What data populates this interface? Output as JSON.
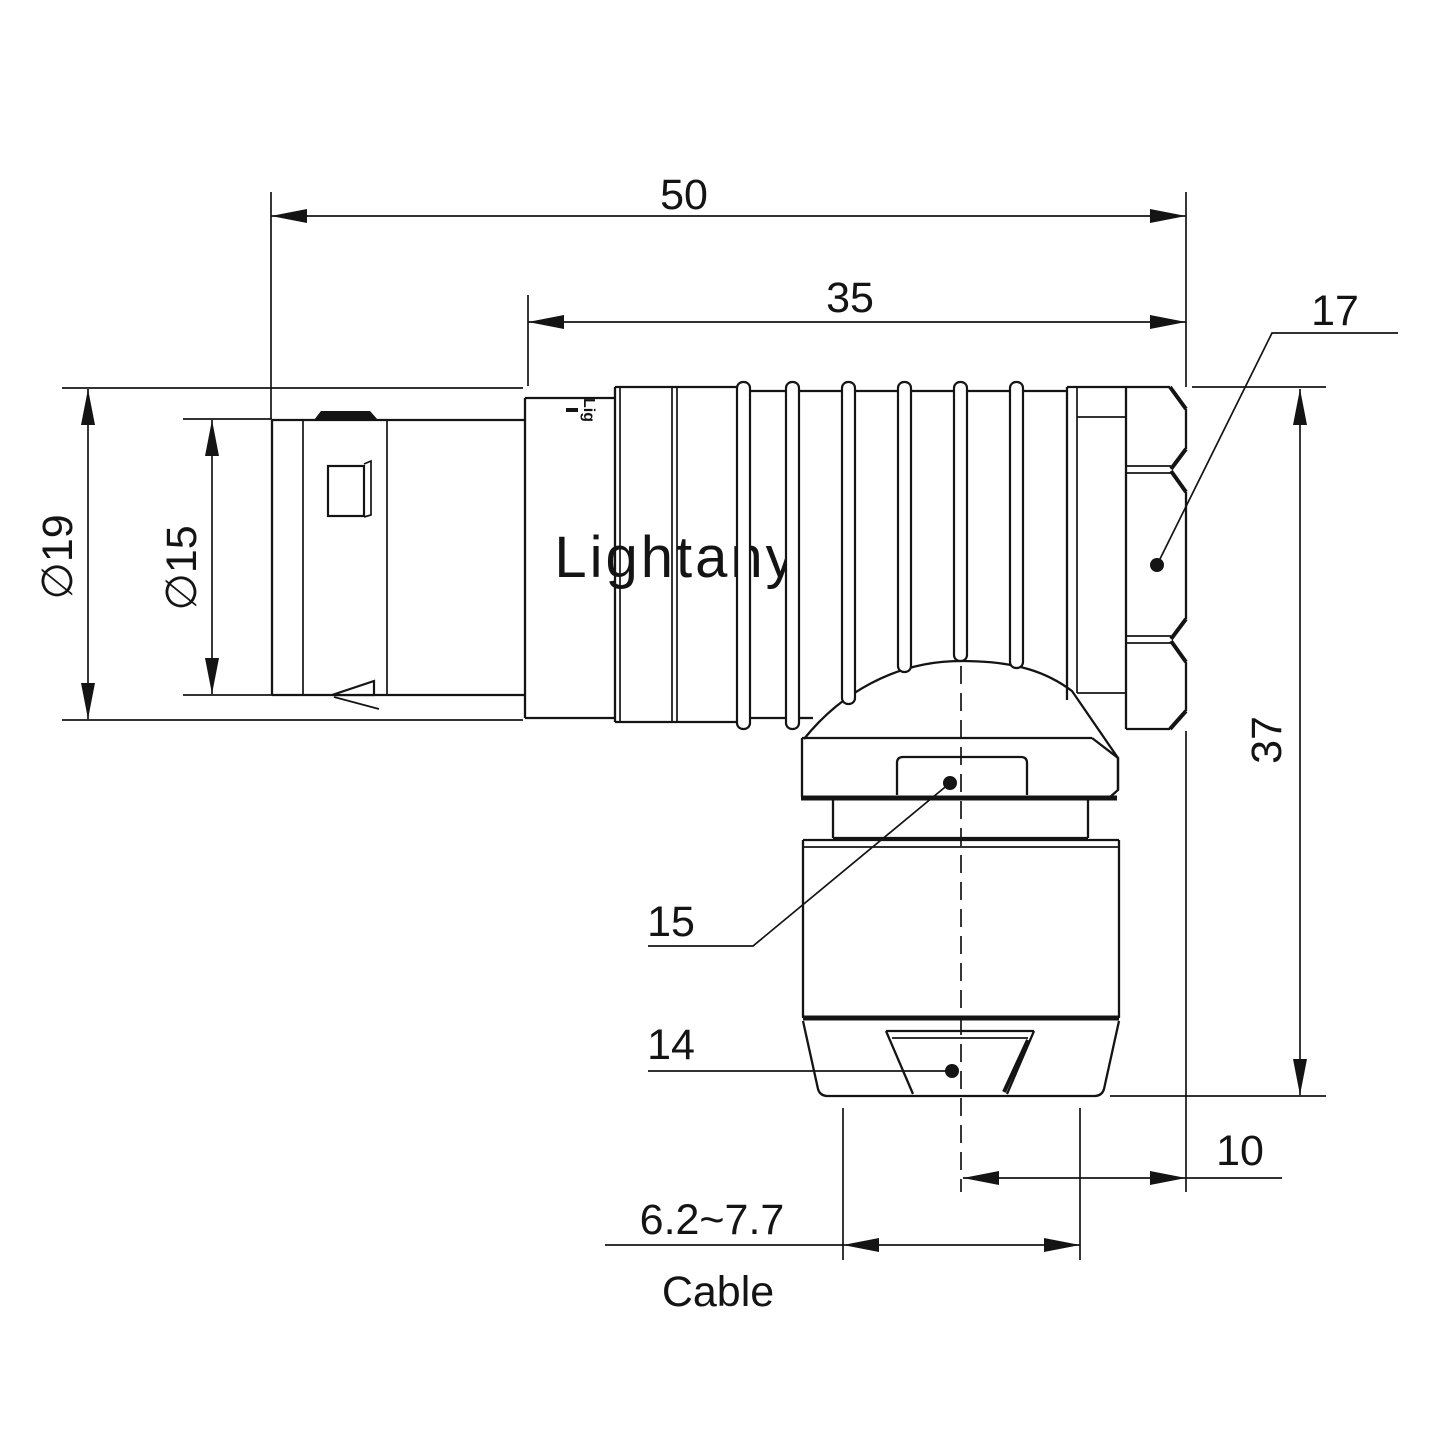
{
  "drawing": {
    "watermark": {
      "text": "Lightany",
      "color": "#f5caca"
    },
    "brand_mark": "Lig",
    "colors": {
      "line": "#141414",
      "background": "#ffffff"
    },
    "dimensions": {
      "length_total": "50",
      "length_coupling": "35",
      "nut_callout": "17",
      "dia_outer": "∅19",
      "dia_inner": "∅15",
      "height_total": "37",
      "clamp_callout": "15",
      "gland_callout": "14",
      "offset_bottom": "10",
      "cable_range": "6.2~7.7",
      "cable_word": "Cable"
    }
  }
}
